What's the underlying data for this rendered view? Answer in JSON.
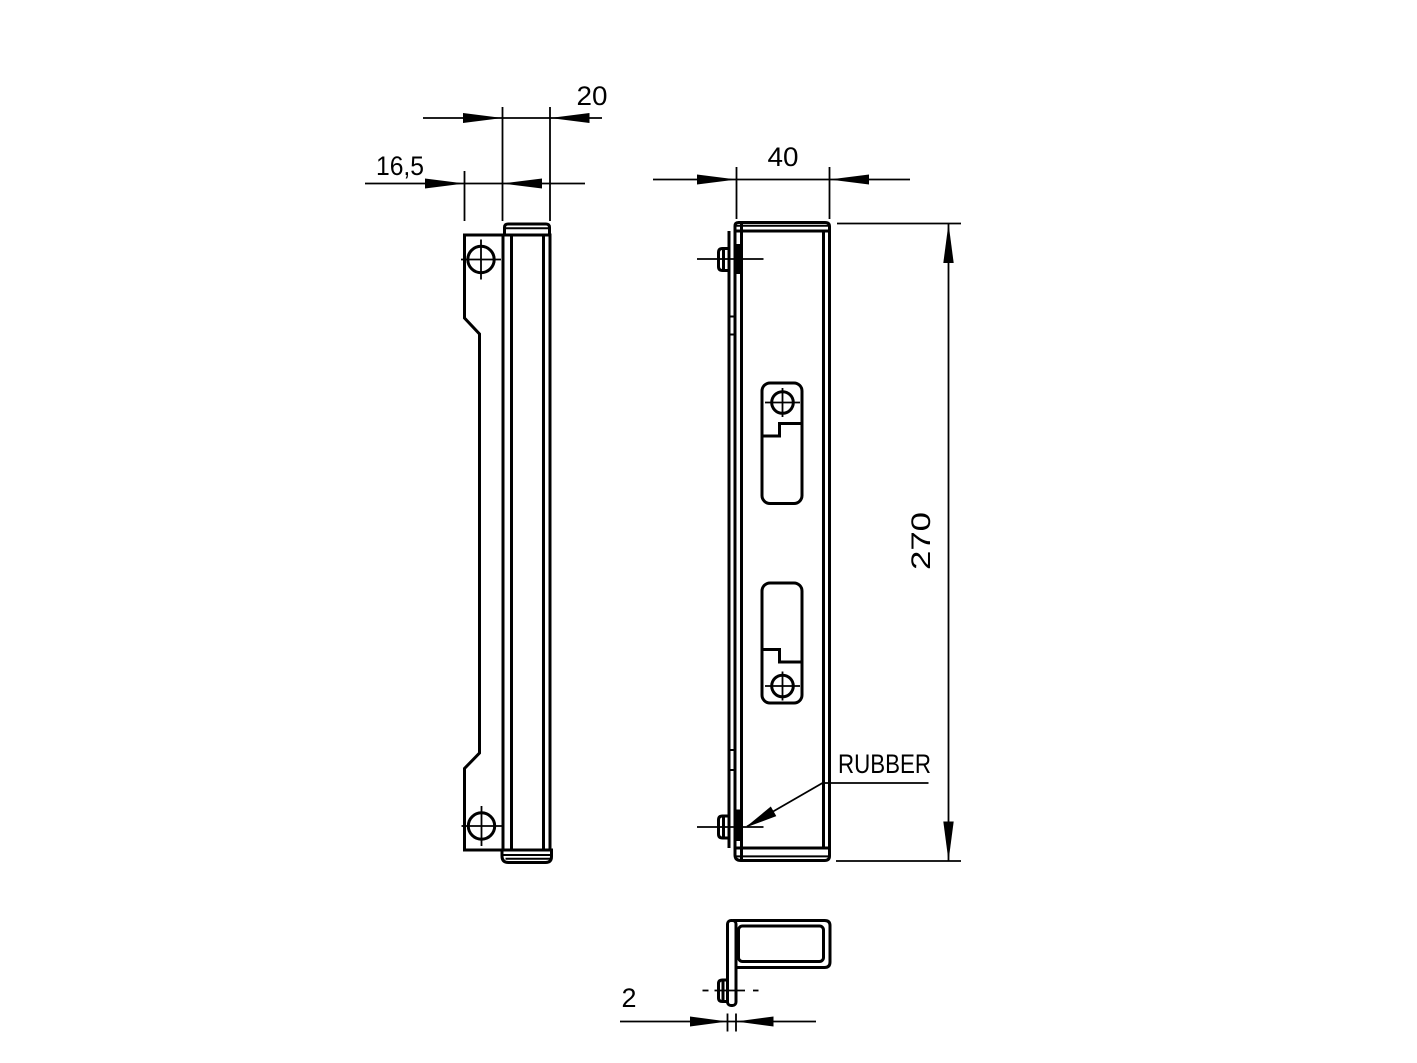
{
  "drawing": {
    "background": "#ffffff",
    "line_color": "#000000",
    "labels": {
      "rubber": "RUBBER"
    },
    "dimensions": {
      "depth": "20",
      "flange_offset": "16,5",
      "width": "40",
      "height": "270",
      "thickness": "2"
    }
  }
}
